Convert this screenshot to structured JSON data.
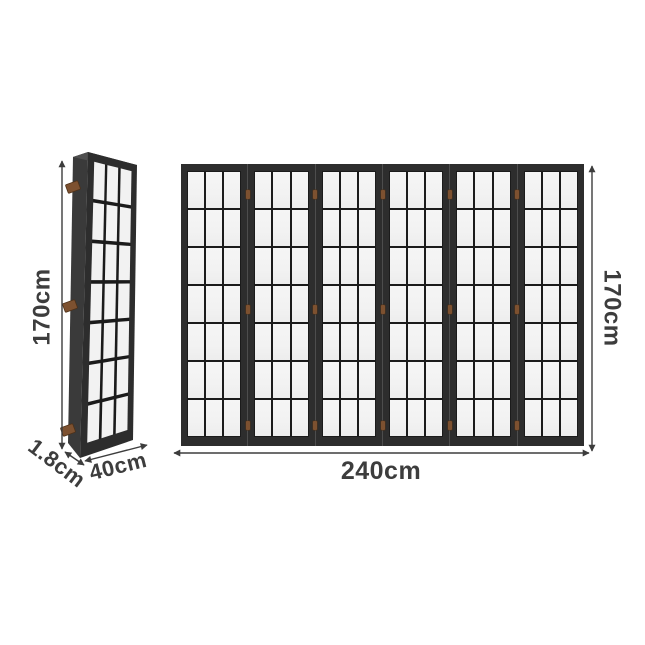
{
  "diagram": {
    "background": "#ffffff",
    "folded_view": {
      "height_label": "170cm",
      "depth_label": "1.8cm",
      "width_label": "40cm",
      "grid_rows": 7,
      "grid_cols": 3,
      "hinge_count": 3
    },
    "unfolded_view": {
      "height_label": "170cm",
      "width_label": "240cm",
      "panel_count": 6,
      "grid_rows": 7,
      "grid_cols": 3,
      "hinges_per_seam": 3
    },
    "colors": {
      "background": "#ffffff",
      "frame": "#2d2d2d",
      "spine": "#3a3a3a",
      "top_edge": "#4f4f4f",
      "muntin": "#1b1b1b",
      "pane": "#f2f2f2",
      "seam": "#4d4d4d",
      "hinge": "#7d5130",
      "dimension": "#3d3d3d"
    }
  }
}
